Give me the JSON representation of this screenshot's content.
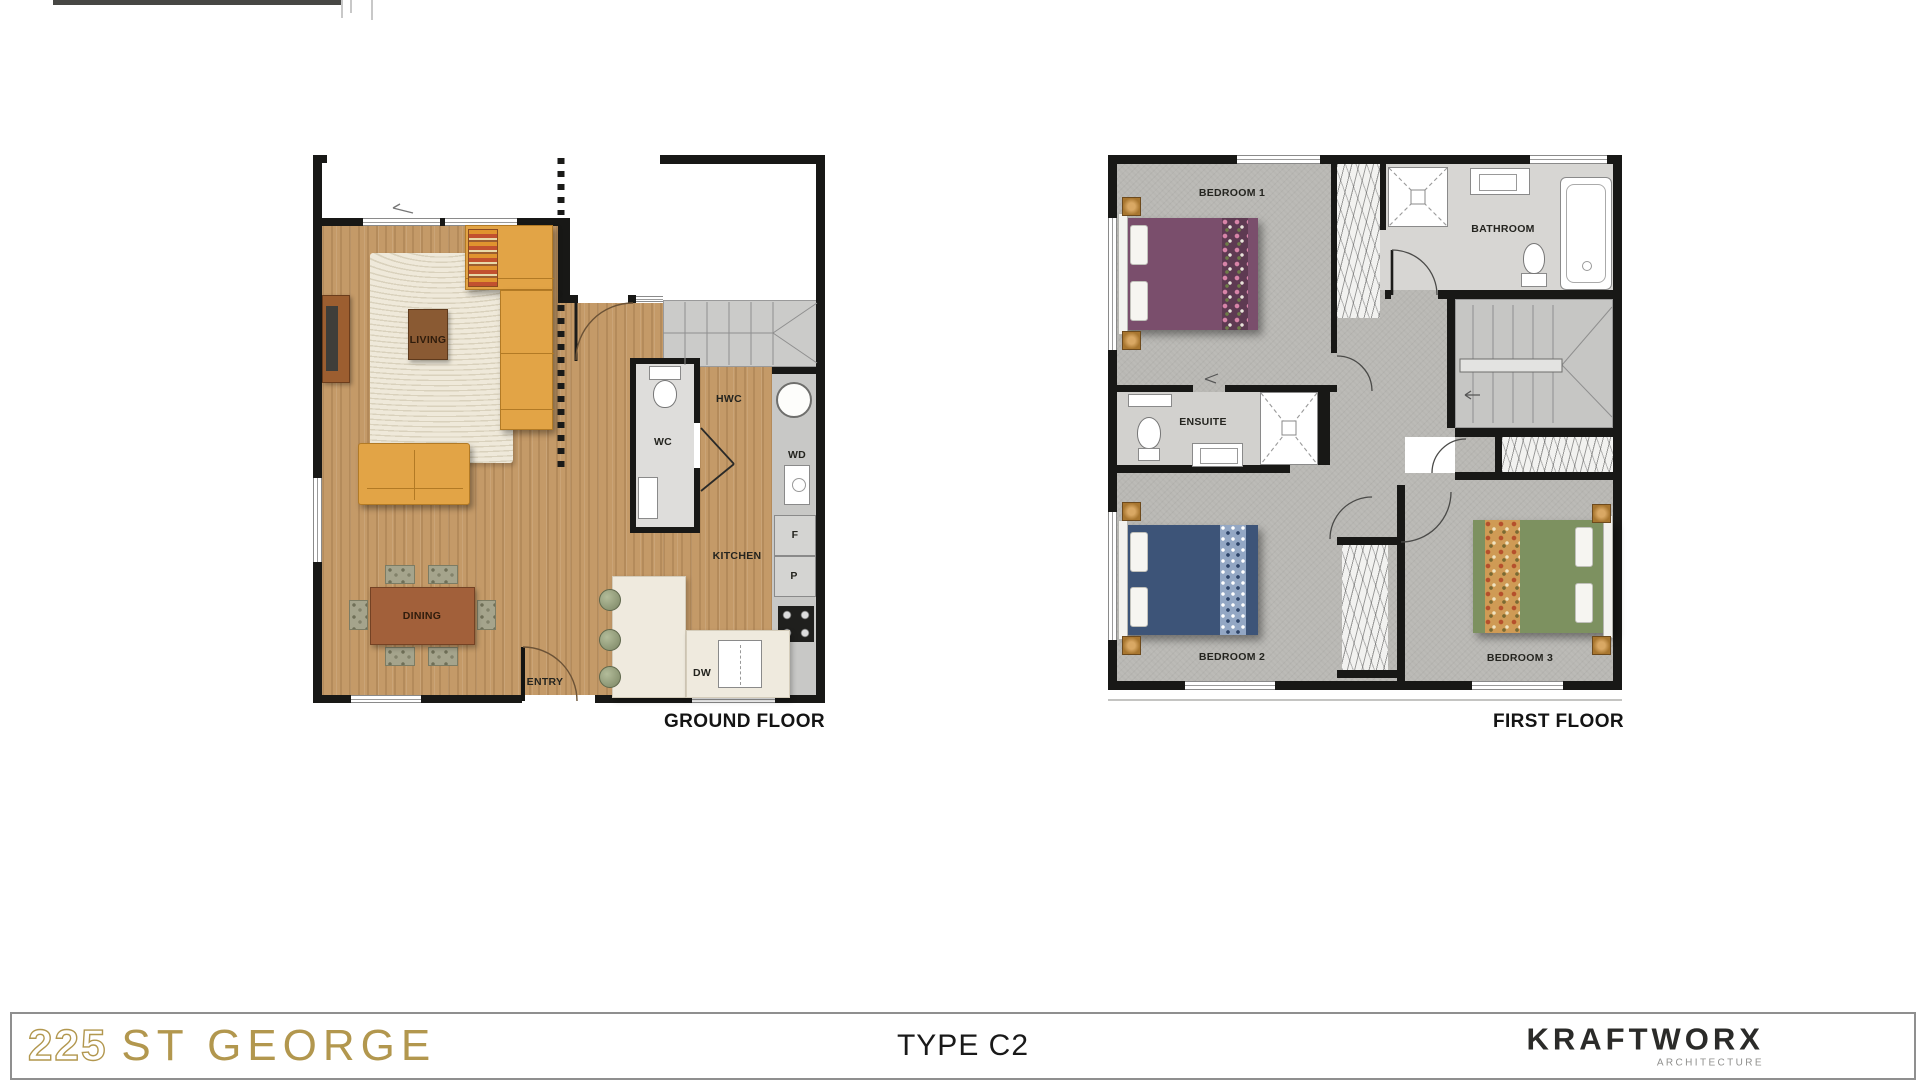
{
  "plans": {
    "ground": {
      "caption": "GROUND FLOOR",
      "labels": {
        "living": "LIVING",
        "dining": "DINING",
        "entry": "ENTRY",
        "wc": "WC",
        "hwc": "HWC",
        "wd": "WD",
        "kitchen": "KITCHEN",
        "fridge": "F",
        "pantry": "P",
        "dishwasher": "DW"
      }
    },
    "first": {
      "caption": "FIRST FLOOR",
      "labels": {
        "bedroom1": "BEDROOM 1",
        "bathroom": "BATHROOM",
        "ensuite": "ENSUITE",
        "bedroom2": "BEDROOM 2",
        "bedroom3": "BEDROOM 3"
      }
    }
  },
  "footer": {
    "project_number": "225",
    "project_name": "ST GEORGE",
    "type_label": "TYPE C2",
    "brand": "KRAFTWORX",
    "brand_tagline": "ARCHITECTURE"
  },
  "colors": {
    "accent_gold": "#b2974e",
    "wall_black": "#181816",
    "wood_floor": "#c49a68",
    "carpet_gray": "#b8b7b3",
    "sofa_orange": "#e2a446",
    "bed_purple": "#7a4e6c",
    "bed_navy": "#3d5478",
    "bed_green": "#7d9160",
    "table_brown": "#a2603a"
  }
}
